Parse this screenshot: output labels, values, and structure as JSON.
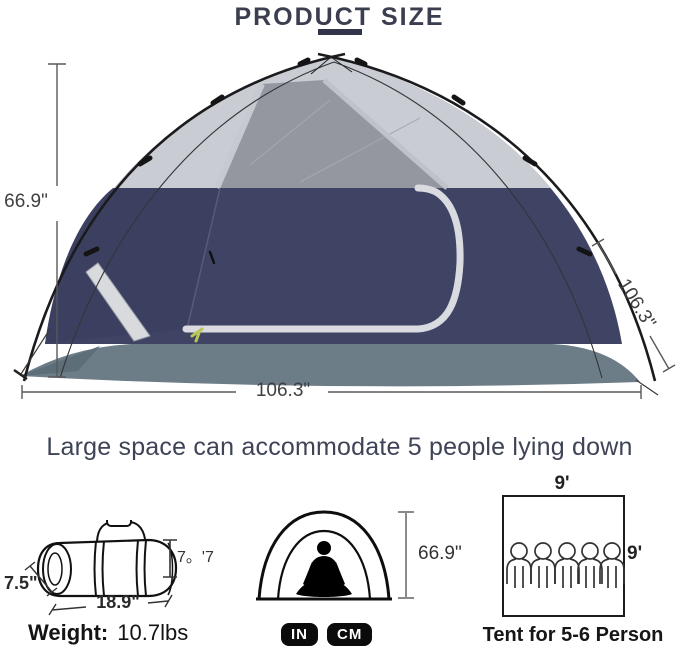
{
  "title": "PRODUCT SIZE",
  "main_diagram": {
    "height_label": "66.9\"",
    "width_label": "106.3\"",
    "depth_label": "106.3\""
  },
  "caption": "Large space can accommodate 5 people lying down",
  "carry_bag": {
    "diameter_label": "7.5\"",
    "length_label": "18.9\"",
    "height_label": "7。'7",
    "weight_title": "Weight:",
    "weight_value": "10.7lbs"
  },
  "standing_tent": {
    "height_label": "66.9\"",
    "unit_badges": [
      "IN",
      "CM"
    ]
  },
  "floor_plan": {
    "width_label": "9'",
    "depth_label": "9'",
    "person_count": 5,
    "caption": "Tent for 5-6 Person"
  },
  "colors": {
    "title_text": "#3a3e4f",
    "accent_underline": "#32354a",
    "tent_navy": "#3f4465",
    "tent_wall_dark": "#3b4060",
    "tent_top_gray": "#c9ccd3",
    "mesh_gray": "#94979f",
    "door_trim": "#d9dbe0",
    "floor_gray": "#6d7d87",
    "badge_bg": "#0b0b0b",
    "badge_text": "#ffffff"
  }
}
